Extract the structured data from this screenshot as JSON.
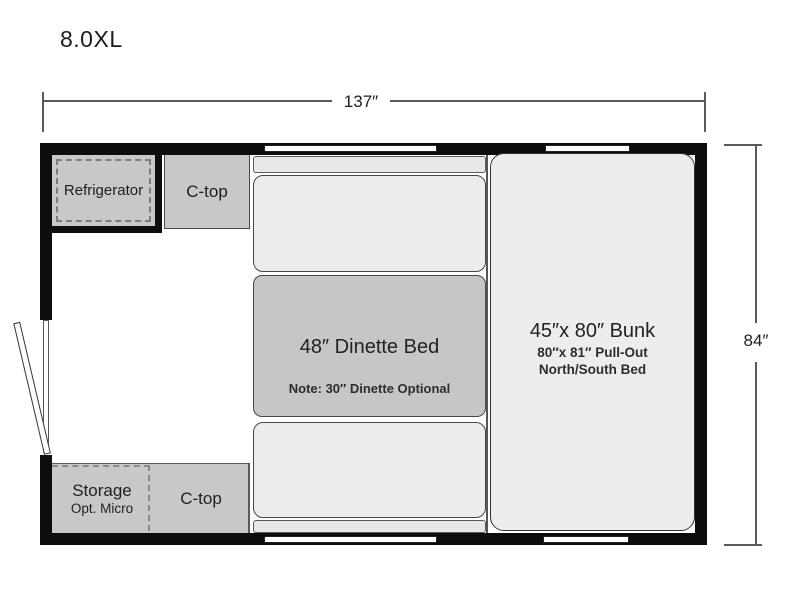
{
  "title": "8.0XL",
  "dimensions": {
    "width_label": "137″",
    "height_label": "84″"
  },
  "floorplan": {
    "refrigerator": {
      "label": "Refrigerator"
    },
    "counter_top_upper": {
      "label": "C-top"
    },
    "dinette": {
      "label": "48″ Dinette Bed",
      "note": "Note: 30″ Dinette Optional"
    },
    "bunk": {
      "label": "45″x 80″ Bunk",
      "subline1": "80″x 81″ Pull-Out",
      "subline2": "North/South Bed"
    },
    "storage": {
      "label": "Storage",
      "sublabel": "Opt. Micro"
    },
    "counter_top_lower": {
      "label": "C-top"
    }
  },
  "colors": {
    "wall": "#0d0d0d",
    "fixture_gray": "#c8c8c8",
    "cushion_gray": "#ececec",
    "table_gray": "#c6c6c6",
    "outline": "#474747",
    "dashed_line": "#7d7d7d",
    "dimension_line": "#5a5a5a",
    "text": "#222222",
    "background": "#ffffff"
  }
}
